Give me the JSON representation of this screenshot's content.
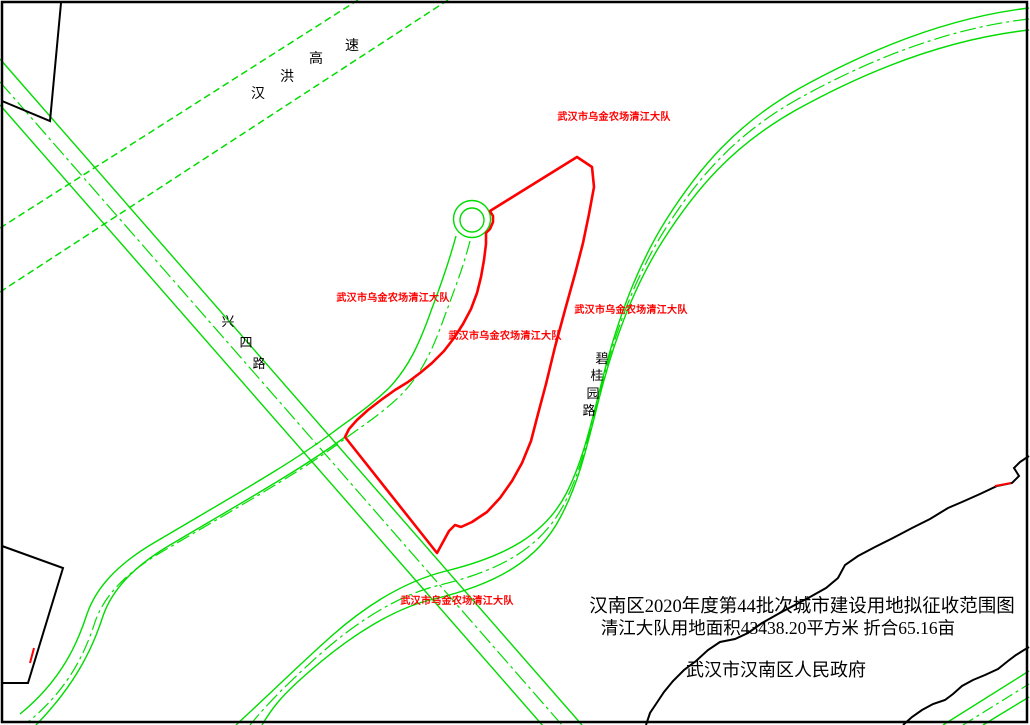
{
  "map": {
    "type": "land-acquisition-plan",
    "title_line1": "汉南区2020年度第44批次城市建设用地拟征收范围图",
    "title_line2": "清江大队用地面积43438.20平方米  折合65.16亩",
    "issuer": "武汉市汉南区人民政府",
    "year": "2020",
    "batch": "第44批次",
    "area_sqm": "43438.20",
    "area_mu": "65.16"
  },
  "parcel": {
    "label": "武汉市乌金农场清江大队",
    "boundary_color": "#ff0000"
  },
  "roads": {
    "expressway": {
      "name": "汉洪高速",
      "chars": [
        "汉",
        "洪",
        "高",
        "速"
      ]
    },
    "xingsi": {
      "name": "兴四路",
      "chars": [
        "兴",
        "四",
        "路"
      ]
    },
    "biguiyuan": {
      "name": "碧桂园路",
      "chars": [
        "碧",
        "桂",
        "园",
        "路"
      ]
    }
  },
  "colors": {
    "road_green": "#00dc00",
    "boundary_red": "#ff0000",
    "line_black": "#000000",
    "background": "#ffffff"
  }
}
